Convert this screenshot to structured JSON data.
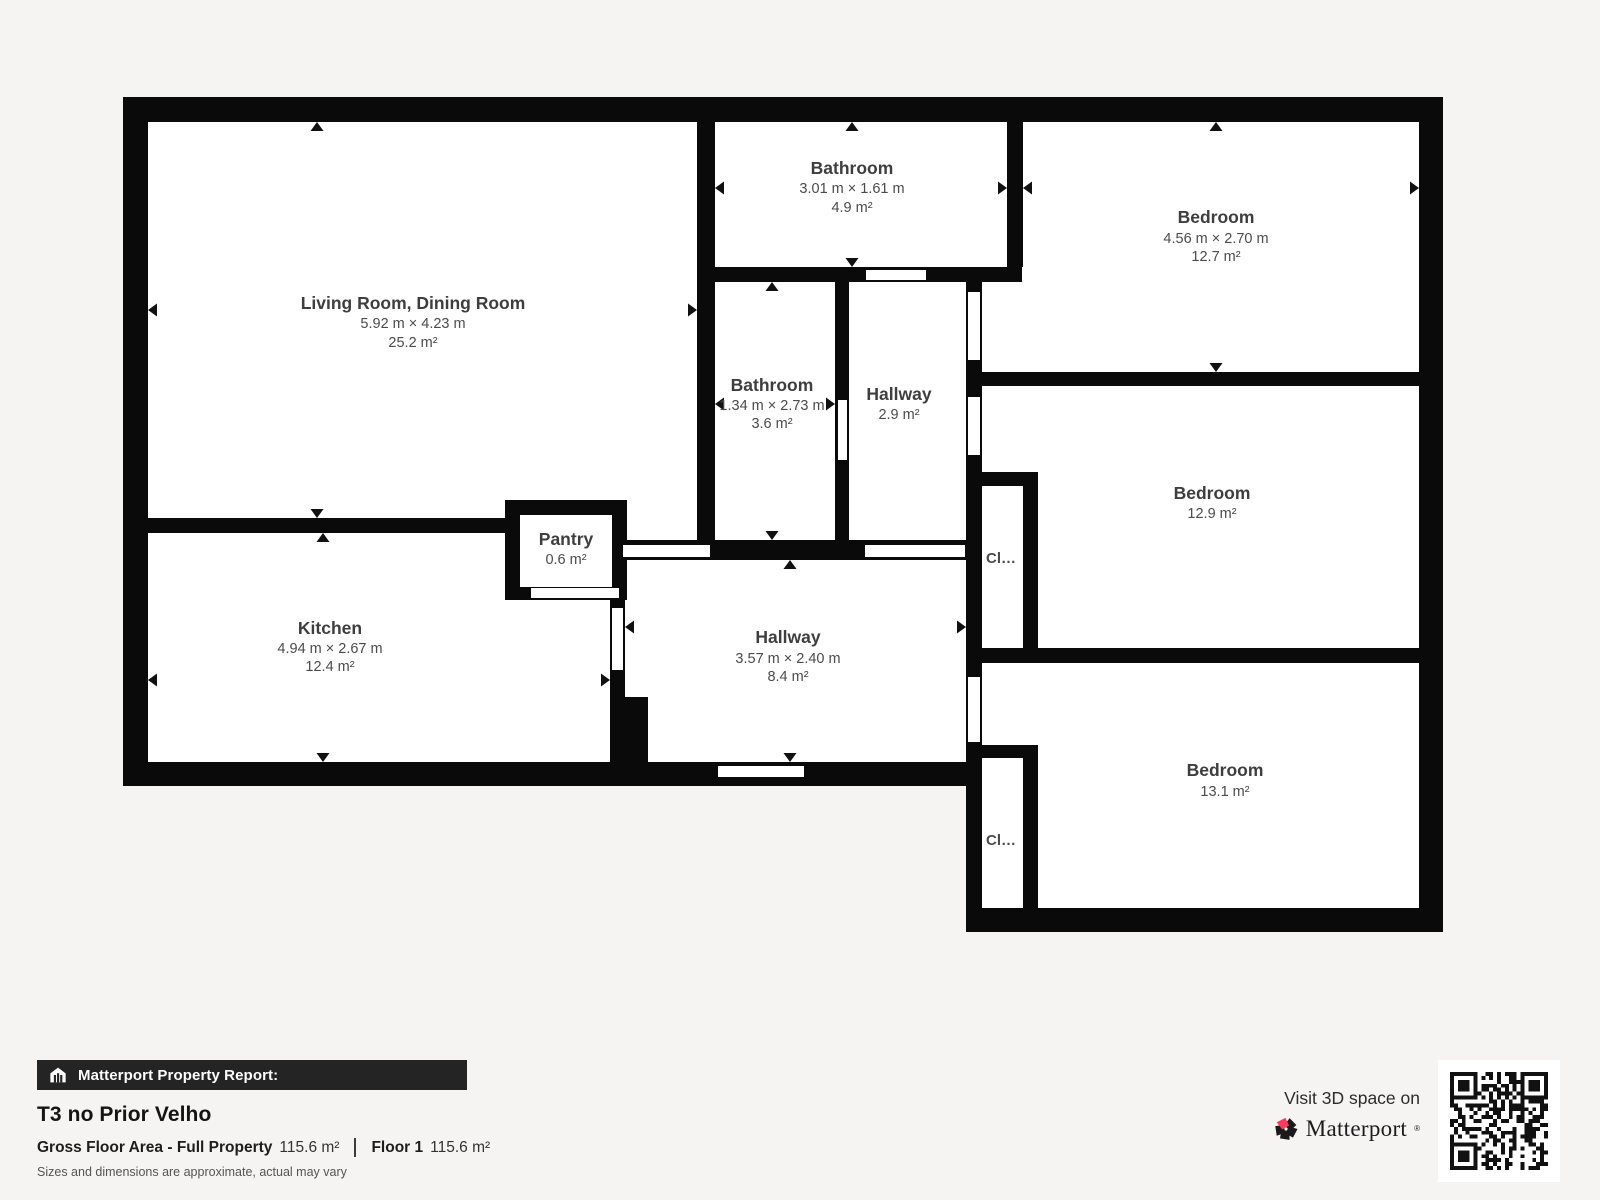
{
  "colors": {
    "page_background": "#f5f4f2",
    "wall": "#0a0a0a",
    "room_floor": "#ffffff",
    "label_text": "#3e3e3e",
    "report_bar_bg": "#242424",
    "brand_pink": "#fb3a5d"
  },
  "plan": {
    "rooms": [
      {
        "id": "living",
        "name": "Living Room, Dining Room",
        "dims": "5.92 m × 4.23 m",
        "area": "25.2 m²"
      },
      {
        "id": "bathroom-top",
        "name": "Bathroom",
        "dims": "3.01 m × 1.61 m",
        "area": "4.9 m²"
      },
      {
        "id": "bedroom-top",
        "name": "Bedroom",
        "dims": "4.56 m × 2.70 m",
        "area": "12.7 m²"
      },
      {
        "id": "bathroom-mid",
        "name": "Bathroom",
        "dims": "1.34 m × 2.73 m",
        "area": "3.6 m²"
      },
      {
        "id": "hallway-mid",
        "name": "Hallway",
        "area": "2.9 m²"
      },
      {
        "id": "bedroom-mid",
        "name": "Bedroom",
        "area": "12.9 m²"
      },
      {
        "id": "kitchen",
        "name": "Kitchen",
        "dims": "4.94 m × 2.67 m",
        "area": "12.4 m²"
      },
      {
        "id": "pantry",
        "name": "Pantry",
        "area": "0.6 m²"
      },
      {
        "id": "hallway-main",
        "name": "Hallway",
        "dims": "3.57 m × 2.40 m",
        "area": "8.4 m²"
      },
      {
        "id": "bedroom-bottom",
        "name": "Bedroom",
        "area": "13.1 m²"
      },
      {
        "id": "closet-upper",
        "name": "Cl…"
      },
      {
        "id": "closet-lower",
        "name": "Cl…"
      }
    ]
  },
  "footer": {
    "report_bar_label": "Matterport Property Report:",
    "title": "T3 no Prior Velho",
    "stats": {
      "gfa_label": "Gross Floor Area - Full Property",
      "gfa_value": "115.6 m²",
      "floor_label": "Floor 1",
      "floor_value": "115.6 m²"
    },
    "disclaimer": "Sizes and dimensions are approximate, actual may vary",
    "cta": {
      "visit": "Visit 3D space on",
      "brand": "Matterport",
      "mark": "®"
    }
  }
}
